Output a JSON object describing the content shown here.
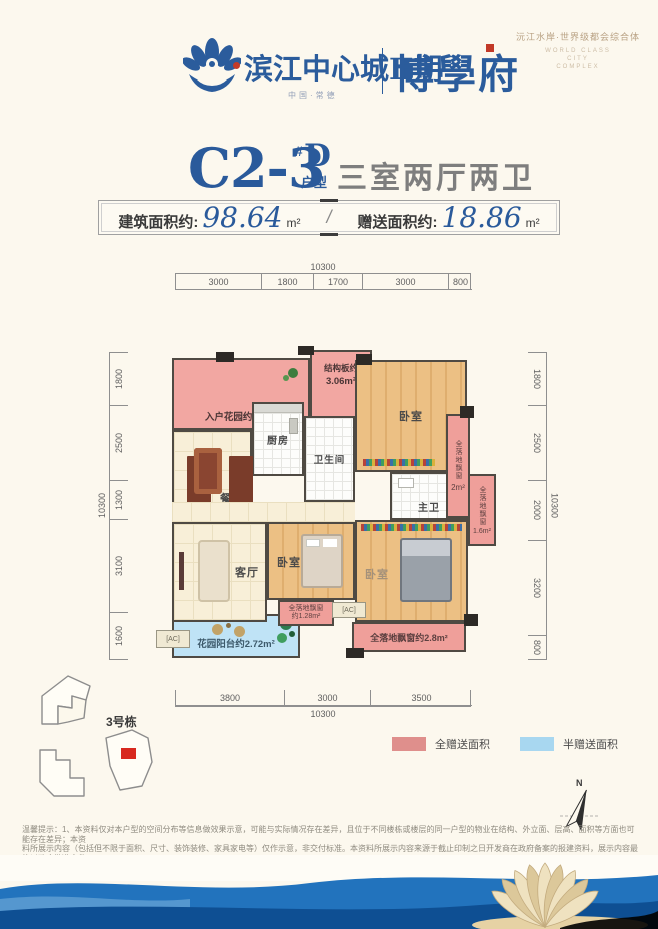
{
  "header": {
    "project_name": "滨江中心城Ⅱ期",
    "project_sub": "中国·常德",
    "brand_name": "博學府",
    "tagline_cn": "沅江水岸·世界级都会综合体",
    "tagline_en_1": "WORLD CLASS",
    "tagline_en_2": "CITY",
    "tagline_en_3": "COMPLEX"
  },
  "title": {
    "unit_code": "C2-3",
    "unit_hash": "#",
    "unit_letter": "D",
    "unit_type": "户型",
    "rooms_desc": "三室两厅两卫"
  },
  "area_banner": {
    "built_label": "建筑面积约:",
    "built_value": "98.64",
    "built_unit": "m²",
    "divider": "/",
    "gift_label": "赠送面积约:",
    "gift_value": "18.86",
    "gift_unit": "m²"
  },
  "dimensions": {
    "top_total": "10300",
    "top": [
      "3000",
      "1800",
      "1700",
      "3000",
      "800"
    ],
    "left_total": "10300",
    "left": [
      "1800",
      "2500",
      "1300",
      "3100",
      "1600"
    ],
    "right_total": "10300",
    "right": [
      "1800",
      "2500",
      "2000",
      "3200",
      "800"
    ],
    "bottom": [
      "3800",
      "3000",
      "3500"
    ],
    "bottom_total": "10300"
  },
  "floorplan": {
    "entry_garden": "入户花园约5.4m²",
    "structure_line1": "结构板约",
    "structure_line2": "3.06m²",
    "kitchen": "厨房",
    "dining": "餐厅",
    "bathroom": "卫生间",
    "bedroom_top": "卧室",
    "bay_2_label": "全落地飘窗",
    "bay_2_value": "2m²",
    "master_bath": "主卫",
    "bay_16_label": "全落地飘窗",
    "bay_16_value": "1.6m²",
    "living": "客厅",
    "bedroom_mid": "卧室",
    "bedroom_master": "卧室",
    "bay_128_label": "全落地飘窗",
    "bay_128_value": "约1.28m²",
    "balcony": "花园阳台约2.72m²",
    "bay_28": "全落地飘窗约2.8m²",
    "ac_label": "[AC]"
  },
  "keyplan": {
    "building_label": "3号栋"
  },
  "legend": {
    "full_gift_label": "全赠送面积",
    "full_gift_color": "#df8f8c",
    "half_gift_label": "半赠送面积",
    "half_gift_color": "#a8d7f0"
  },
  "compass": {
    "north_label": "N"
  },
  "disclaimer": {
    "line1": "温馨提示：1、本资料仅对本户型的空间分布等信息做效果示意，可能与实际情况存在差异，且位于不同楼栋或楼层的同一户型的物业在结构、外立面、层高、面积等方面也可能存在差异；本资",
    "line2": "料所展示内容（包括但不限于面积、尺寸、装饰装修、家具家电等）仅作示意，非交付标准。本资料所展示内容来源于截止印制之日开发商在政府备案的报建资料，展示内容最终以政府批准文件",
    "line3": "及《商品房买卖合同》（含补充协议）约定为准，开发商不对展示内容做承诺担保。、本资料为要约邀请，若本资料所展示内容发生变化。"
  },
  "colors": {
    "brand_blue": "#2b5c9c",
    "full_gift_area": "#f2a7a2",
    "half_gift_area": "#bfe3f6",
    "wave_blue": "#2273bd",
    "wave_navy": "#0e4f93"
  }
}
